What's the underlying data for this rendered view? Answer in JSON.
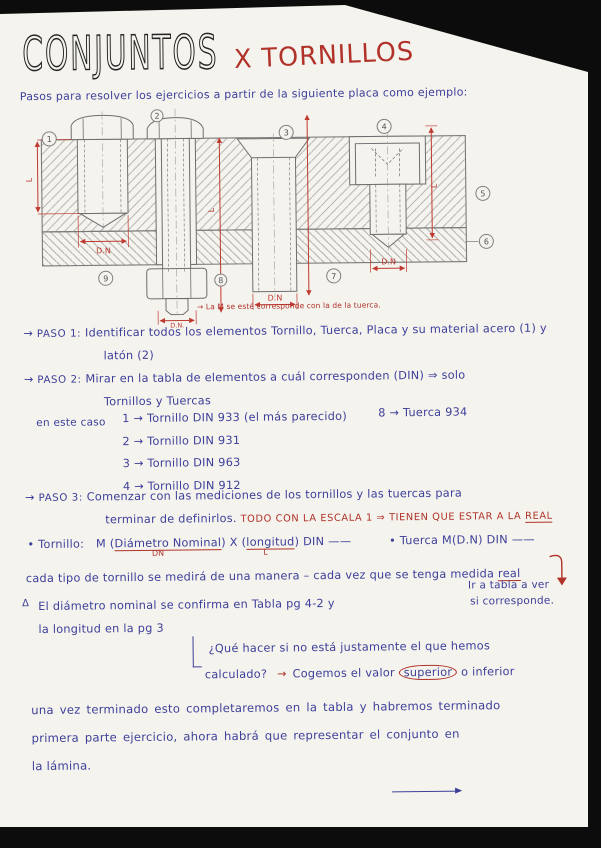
{
  "title": {
    "main": "CONJUNTOS",
    "sub": "X TORNILLOS"
  },
  "intro": "Pasos para resolver los ejercicios a partir de la siguiente placa como ejemplo:",
  "drawing": {
    "callouts": [
      "1",
      "2",
      "3",
      "4",
      "5",
      "6",
      "7",
      "8",
      "9"
    ],
    "dim_l": "L",
    "dim_dn": "D.N",
    "nut_dim": "D.N.",
    "note_red": "→ La M se esté corresponde con la de la tuerca."
  },
  "steps": {
    "arrow": "→",
    "paso1_label": "PASO 1:",
    "paso1_line1": "Identificar todos los elementos Tornillo, Tuerca, Placa y su material acero (1) y",
    "paso1_line2": "latón (2)",
    "paso2_label": "PASO 2:",
    "paso2_line1": "Mirar en la tabla de elementos a cuál corresponden (DIN) ⇒ solo",
    "paso2_line2": "Tornillos y Tuercas",
    "case_label": "en este caso",
    "case_items": [
      "1 → Tornillo  DIN 933 (el más parecido)",
      "2 → Tornillo  DIN  931",
      "3 → Tornillo  DIN  963",
      "4 → Tornillo  DIN  912"
    ],
    "case_nut": "8 → Tuerca  934",
    "paso3_label": "PASO 3:",
    "paso3_line1": "Comenzar con las mediciones de los tornillos y las tuercas  para",
    "paso3_line2": "terminar de definirlos.",
    "paso3_red": "TODO CON LA ESCALA 1 ⇒ TIENEN QUE ESTAR A LA",
    "paso3_red_underlined": "REAL"
  },
  "formula": {
    "tornillo_label": "• Tornillo:",
    "m_open": "M (",
    "dn_word": "Diámetro Nominal",
    "x_mid": ") X (",
    "l_word": "longitud",
    "close": ") DIN ——",
    "dn_mark": "DN",
    "l_mark": "L",
    "tuerca_label": "• Tuerca",
    "tuerca_formula": "M(D.N)  DIN ——",
    "measure_note": "cada tipo de tornillo se medirá de una manera – cada vez que se tenga medida",
    "measure_note_underlined": "real"
  },
  "notes": {
    "side_line1": "Ir a tabla a ver",
    "side_line2": "si corresponde.",
    "warning_mark": "Δ",
    "diam_line1": "El diámetro nominal  se confirma en Tabla pg 4-2  y",
    "diam_line2": "la longitud en la pg 3",
    "q_line1": "¿Qué hacer si no está justamente el que hemos",
    "q_line2": "calculado?",
    "q_arrow": "→",
    "q_pre": "Cogemos el valor",
    "q_circled": "superior",
    "q_post": "o inferior"
  },
  "footer": {
    "line1": "una vez terminado esto completaremos en la tabla  y habremos terminado",
    "line2": "primera parte ejercicio, ahora habrá que representar  el conjunto en",
    "line3": "la lámina."
  }
}
